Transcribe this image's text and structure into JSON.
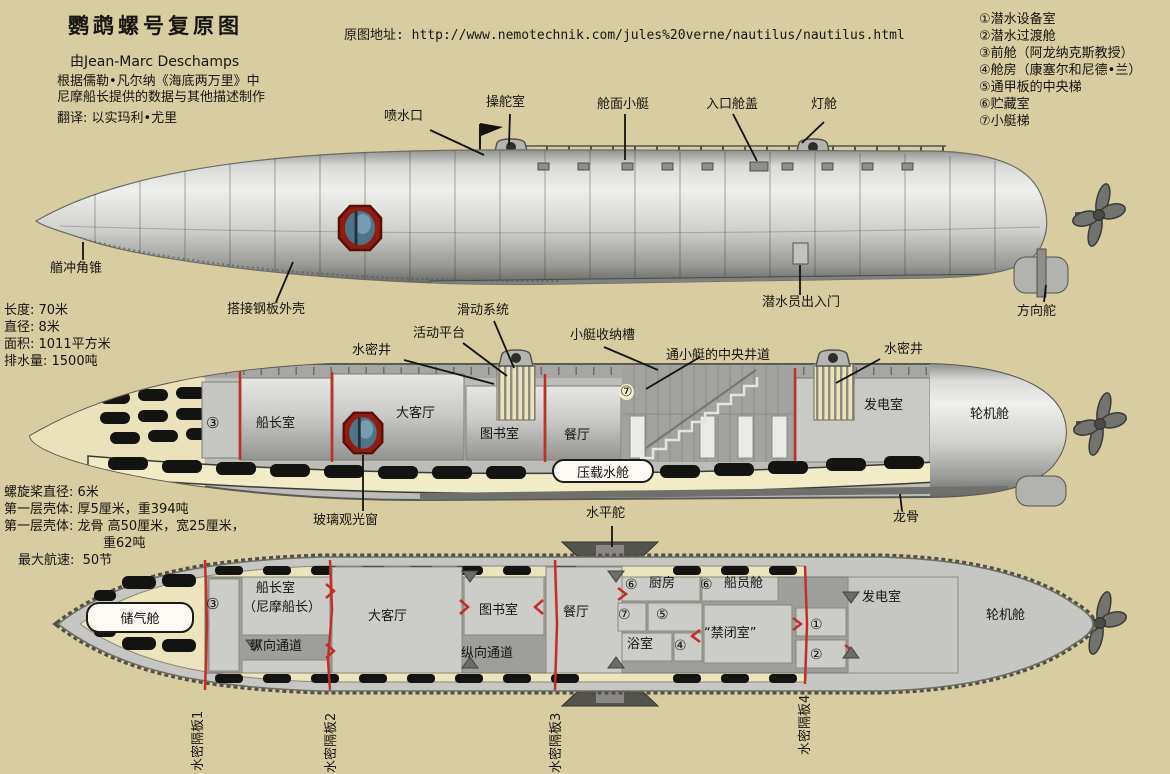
{
  "header": {
    "title": "鹦鹉螺号复原图",
    "author": "由Jean-Marc Deschamps",
    "desc1": "根据儒勒•凡尔纳《海底两万里》中",
    "desc2": "尼摩船长提供的数据与其他描述制作",
    "translator": "翻译: 以实玛利•尤里",
    "source": "原图地址: http://www.nemotechnik.com/jules%20verne/nautilus/nautilus.html"
  },
  "legend": {
    "items": [
      "①潜水设备室",
      "②潜水过渡舱",
      "③前舱（阿龙纳克斯教授）",
      "④舱房（康塞尔和尼德•兰）",
      "⑤通甲板的中央梯",
      "⑥贮藏室",
      "⑦小艇梯"
    ]
  },
  "specs_top": {
    "lines": [
      "长度: 70米",
      "直径: 8米",
      "面积: 1011平方米",
      "排水量: 1500吨"
    ]
  },
  "specs_mid": {
    "lines": [
      "螺旋桨直径: 6米",
      "第一层壳体: 厚5厘米，重394吨",
      "第一层壳体: 龙骨 高50厘米，宽25厘米，",
      "重62吨",
      "最大航速:  50节"
    ]
  },
  "side_view": {
    "spray": "喷水口",
    "helm": "操舵室",
    "deck_boat": "舱面小艇",
    "hatch": "入口舱盖",
    "light": "灯舱",
    "ram": "艏冲角锥",
    "plating": "搭接钢板外壳",
    "diver_door": "潜水员出入门",
    "rudder": "方向舵"
  },
  "cutaway_view": {
    "well_left": "水密井",
    "platform": "活动平台",
    "sliding": "滑动系统",
    "boat_slot": "小艇收纳槽",
    "central_shaft": "通小艇的中央井道",
    "well_right": "水密井",
    "num3": "③",
    "captain": "船长室",
    "salon": "大客厅",
    "library": "图书室",
    "dining": "餐厅",
    "num7": "⑦",
    "ballast": "压载水舱",
    "generator": "发电室",
    "engine": "轮机舱",
    "window": "玻璃观光窗",
    "hydroplane": "水平舵",
    "keel": "龙骨"
  },
  "plan_view": {
    "air_tank": "储气舱",
    "num3": "③",
    "captain_1": "船长室",
    "captain_2": "（尼摩船长）",
    "salon": "大客厅",
    "passage_fwd": "纵向通道",
    "library": "图书室",
    "passage_mid": "纵向通道",
    "dining": "餐厅",
    "num6_kitchen": "⑥",
    "kitchen": "厨房",
    "num6_crew": "⑥",
    "crew": "船员舱",
    "num7": "⑦",
    "num5": "⑤",
    "bath": "浴室",
    "num4": "④",
    "brig": "“禁闭室”",
    "num1": "①",
    "num2": "②",
    "generator": "发电室",
    "engine": "轮机舱"
  },
  "bulkheads": {
    "items": [
      "水密隔板1",
      "水密隔板2",
      "水密隔板3",
      "水密隔板4"
    ]
  },
  "colors": {
    "background": "#d7cda0",
    "hull_light": "#efefed",
    "hull_dark": "#676763",
    "accent_red": "#c22f26",
    "porthole_rim": "#8f1d12",
    "porthole_glass": "#4f7488",
    "ballast_cream": "#f2ecc6"
  }
}
